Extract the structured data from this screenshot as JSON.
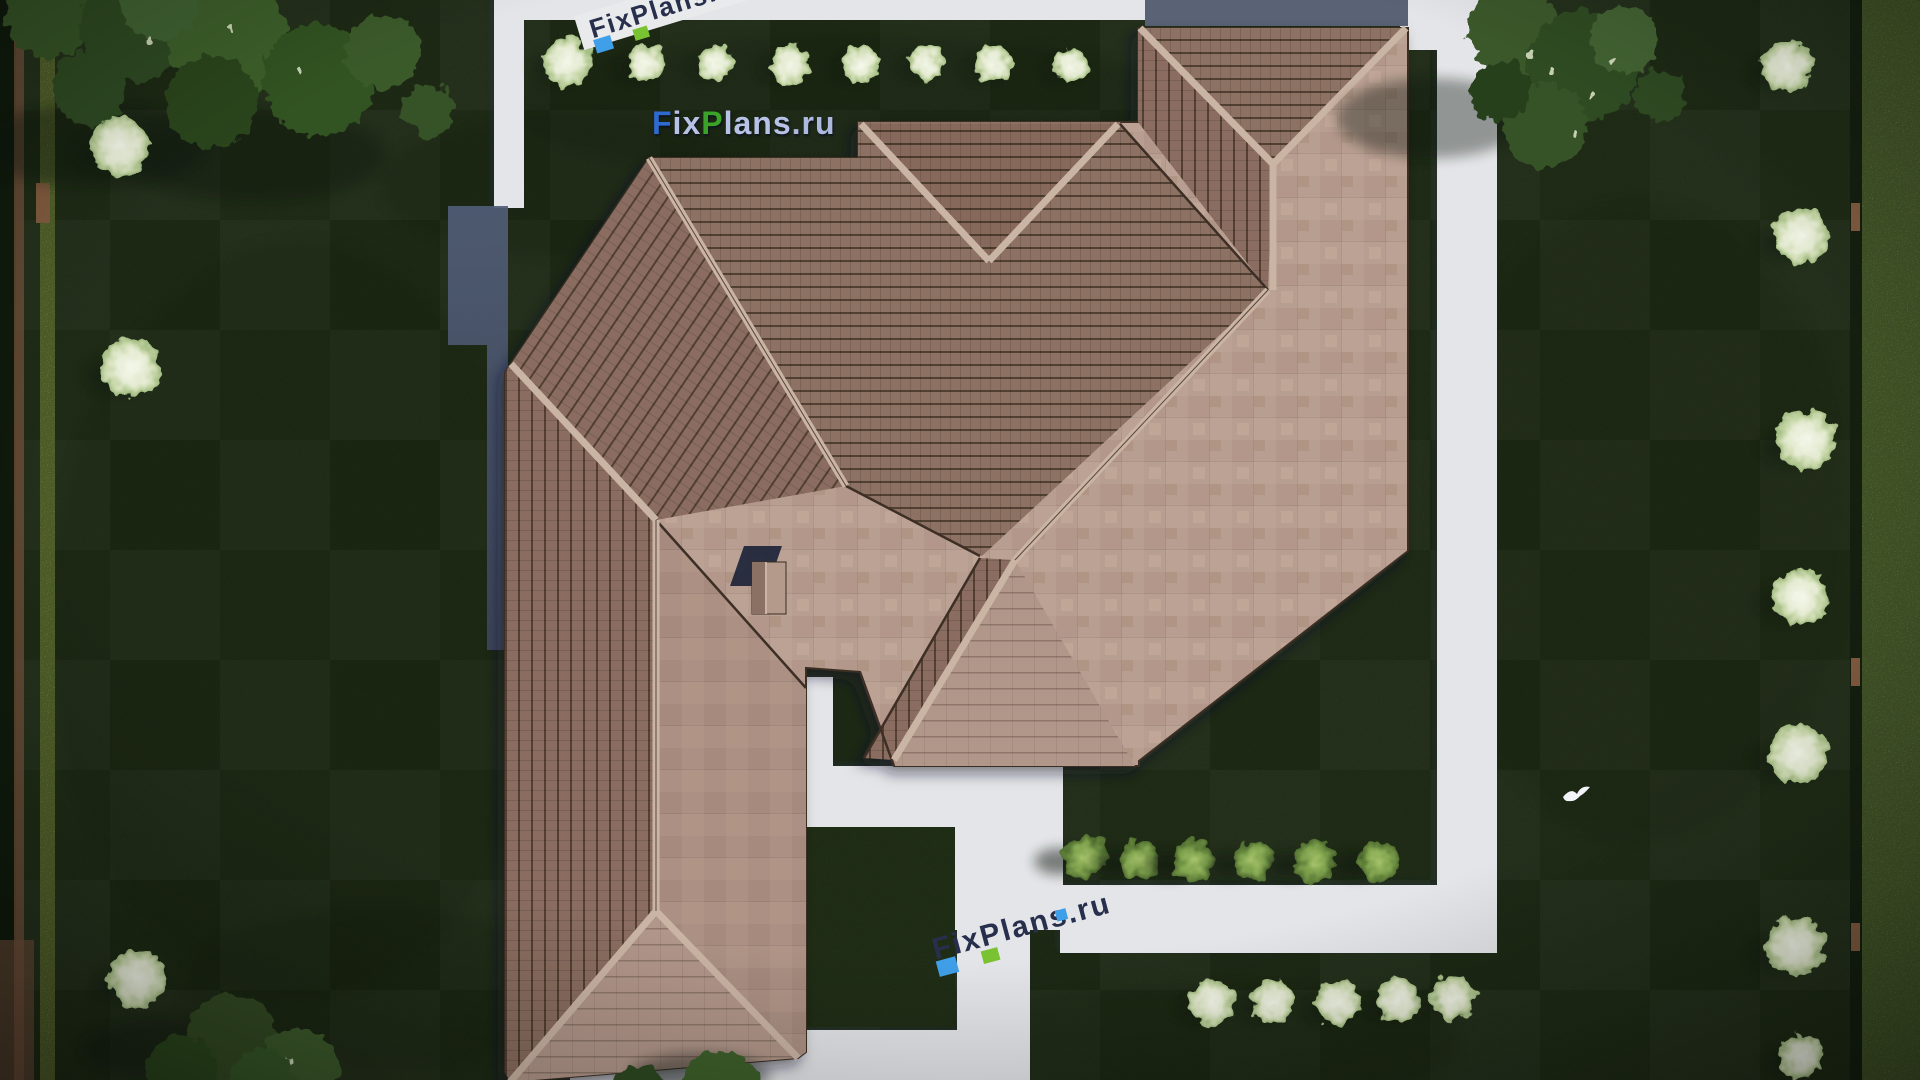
{
  "watermarks": {
    "main": {
      "text": "FixPlans.ru",
      "segments": [
        {
          "t": "F",
          "c": "#2e6ad0"
        },
        {
          "t": "ix",
          "c": "#b7c2e6"
        },
        {
          "t": "P",
          "c": "#3aa228"
        },
        {
          "t": "lans",
          "c": "#b7c2e6"
        },
        {
          "t": ".ru",
          "c": "#aeb9e0"
        }
      ]
    },
    "path_logo": {
      "text": "FixPlans.ru",
      "dark": "#272f4d",
      "blue": "#3f9fe8",
      "green": "#79c231"
    }
  },
  "palette": {
    "lawn": "#2a3b1e",
    "lawn_dark": "#16220f",
    "path": "#e4e5e8",
    "blue_strip": "#5a6375",
    "shadow_blue_top": "#515d77",
    "shadow_blue_bottom": "#3f485f",
    "roof_light": "#b89e90",
    "roof_striped": "#8d7164",
    "ridge": "#cab4a4",
    "roof_edge": "#3a2d23",
    "hedge_right": "#7fa34d",
    "hedge_left_line": "#9cb851",
    "hedge_dark": "#0f1a0c",
    "fence": "#6f4f3a",
    "post": "#7f5a3e",
    "chimney_shadow": "#1c2438",
    "chimney_body": "#b49a8a",
    "chimney_west": "#8b7163",
    "bird": "#f2f4f7"
  },
  "scene": {
    "lawn_patches": [
      {
        "x": 850,
        "y": 105,
        "rx": 340,
        "ry": 70,
        "o": 0.22
      },
      {
        "x": 300,
        "y": 620,
        "rx": 250,
        "ry": 380,
        "o": 0.15
      },
      {
        "x": 1640,
        "y": 520,
        "rx": 210,
        "ry": 320,
        "o": 0.13
      },
      {
        "x": 1200,
        "y": 1045,
        "rx": 260,
        "ry": 60,
        "o": 0.18
      },
      {
        "x": 560,
        "y": 185,
        "rx": 180,
        "ry": 70,
        "o": 0.2
      },
      {
        "x": 380,
        "y": 990,
        "rx": 200,
        "ry": 80,
        "o": 0.18
      }
    ],
    "tree_shadows": [
      {
        "x": 95,
        "y": 145,
        "rx": 115,
        "ry": 42
      },
      {
        "x": 255,
        "y": 155,
        "rx": 130,
        "ry": 45
      },
      {
        "x": 1432,
        "y": 118,
        "rx": 95,
        "ry": 40
      },
      {
        "x": 165,
        "y": 1048,
        "rx": 85,
        "ry": 30
      },
      {
        "x": 700,
        "y": 1075,
        "rx": 70,
        "ry": 22
      }
    ],
    "trees": [
      {
        "x": 50,
        "y": 14,
        "r": 44,
        "c": "#355226"
      },
      {
        "x": 135,
        "y": 27,
        "r": 54,
        "c": "#2e4a20"
      },
      {
        "x": 228,
        "y": 39,
        "r": 60,
        "c": "#3d5e2c"
      },
      {
        "x": 318,
        "y": 80,
        "r": 56,
        "c": "#335224"
      },
      {
        "x": 212,
        "y": 102,
        "r": 46,
        "c": "#2a451e"
      },
      {
        "x": 383,
        "y": 52,
        "r": 38,
        "c": "#3a5a29"
      },
      {
        "x": 90,
        "y": 88,
        "r": 38,
        "c": "#2e4a20"
      },
      {
        "x": 428,
        "y": 110,
        "r": 26,
        "c": "#355226"
      },
      {
        "x": 160,
        "y": 0,
        "r": 40,
        "c": "#406230"
      },
      {
        "x": 1515,
        "y": 30,
        "r": 46,
        "c": "#3a5829"
      },
      {
        "x": 1582,
        "y": 66,
        "r": 56,
        "c": "#2f4c21"
      },
      {
        "x": 1546,
        "y": 126,
        "r": 42,
        "c": "#365327"
      },
      {
        "x": 1624,
        "y": 40,
        "r": 34,
        "c": "#426232"
      },
      {
        "x": 1660,
        "y": 96,
        "r": 26,
        "c": "#2e4a20"
      },
      {
        "x": 1500,
        "y": 92,
        "r": 30,
        "c": "#283f1a"
      },
      {
        "x": 232,
        "y": 1040,
        "r": 46,
        "c": "#304920"
      },
      {
        "x": 298,
        "y": 1068,
        "r": 40,
        "c": "#3a5929"
      },
      {
        "x": 182,
        "y": 1072,
        "r": 36,
        "c": "#2c451d"
      },
      {
        "x": 262,
        "y": 1082,
        "r": 34,
        "c": "#365427"
      },
      {
        "x": 720,
        "y": 1090,
        "r": 40,
        "c": "#3d5e2c"
      },
      {
        "x": 640,
        "y": 1095,
        "r": 30,
        "c": "#2e4a20"
      }
    ],
    "tree_sparkles": [
      {
        "x": 1552,
        "y": 70
      },
      {
        "x": 1592,
        "y": 96
      },
      {
        "x": 1530,
        "y": 54
      },
      {
        "x": 1574,
        "y": 132
      },
      {
        "x": 1612,
        "y": 62
      },
      {
        "x": 232,
        "y": 30
      },
      {
        "x": 300,
        "y": 70
      },
      {
        "x": 150,
        "y": 40
      },
      {
        "x": 290,
        "y": 1060
      }
    ],
    "bushes_white": [
      {
        "x": 120,
        "y": 146,
        "r": 30
      },
      {
        "x": 131,
        "y": 368,
        "r": 30
      },
      {
        "x": 137,
        "y": 978,
        "r": 29
      },
      {
        "x": 567,
        "y": 62,
        "r": 24
      },
      {
        "x": 645,
        "y": 63,
        "r": 19
      },
      {
        "x": 716,
        "y": 63,
        "r": 18
      },
      {
        "x": 790,
        "y": 64,
        "r": 20
      },
      {
        "x": 861,
        "y": 64,
        "r": 18
      },
      {
        "x": 926,
        "y": 63,
        "r": 17
      },
      {
        "x": 993,
        "y": 64,
        "r": 19
      },
      {
        "x": 1071,
        "y": 65,
        "r": 18
      },
      {
        "x": 1787,
        "y": 66,
        "r": 26
      },
      {
        "x": 1801,
        "y": 236,
        "r": 28
      },
      {
        "x": 1806,
        "y": 440,
        "r": 30
      },
      {
        "x": 1800,
        "y": 597,
        "r": 28
      },
      {
        "x": 1798,
        "y": 754,
        "r": 30
      },
      {
        "x": 1795,
        "y": 946,
        "r": 30
      },
      {
        "x": 1801,
        "y": 1056,
        "r": 22
      },
      {
        "x": 1212,
        "y": 1002,
        "r": 23
      },
      {
        "x": 1273,
        "y": 1002,
        "r": 22
      },
      {
        "x": 1338,
        "y": 1003,
        "r": 23
      },
      {
        "x": 1398,
        "y": 1000,
        "r": 22
      },
      {
        "x": 1453,
        "y": 998,
        "r": 22
      }
    ],
    "bushes_green": [
      {
        "x": 1085,
        "y": 857,
        "r": 22
      },
      {
        "x": 1140,
        "y": 860,
        "r": 20
      },
      {
        "x": 1194,
        "y": 861,
        "r": 21
      },
      {
        "x": 1254,
        "y": 861,
        "r": 20
      },
      {
        "x": 1315,
        "y": 861,
        "r": 21
      },
      {
        "x": 1379,
        "y": 861,
        "r": 20
      }
    ],
    "fence_posts_right": [
      203,
      658,
      923
    ],
    "fence_post_left": {
      "x": 36,
      "y": 183
    },
    "bird": {
      "x": 1575,
      "y": 795
    }
  }
}
